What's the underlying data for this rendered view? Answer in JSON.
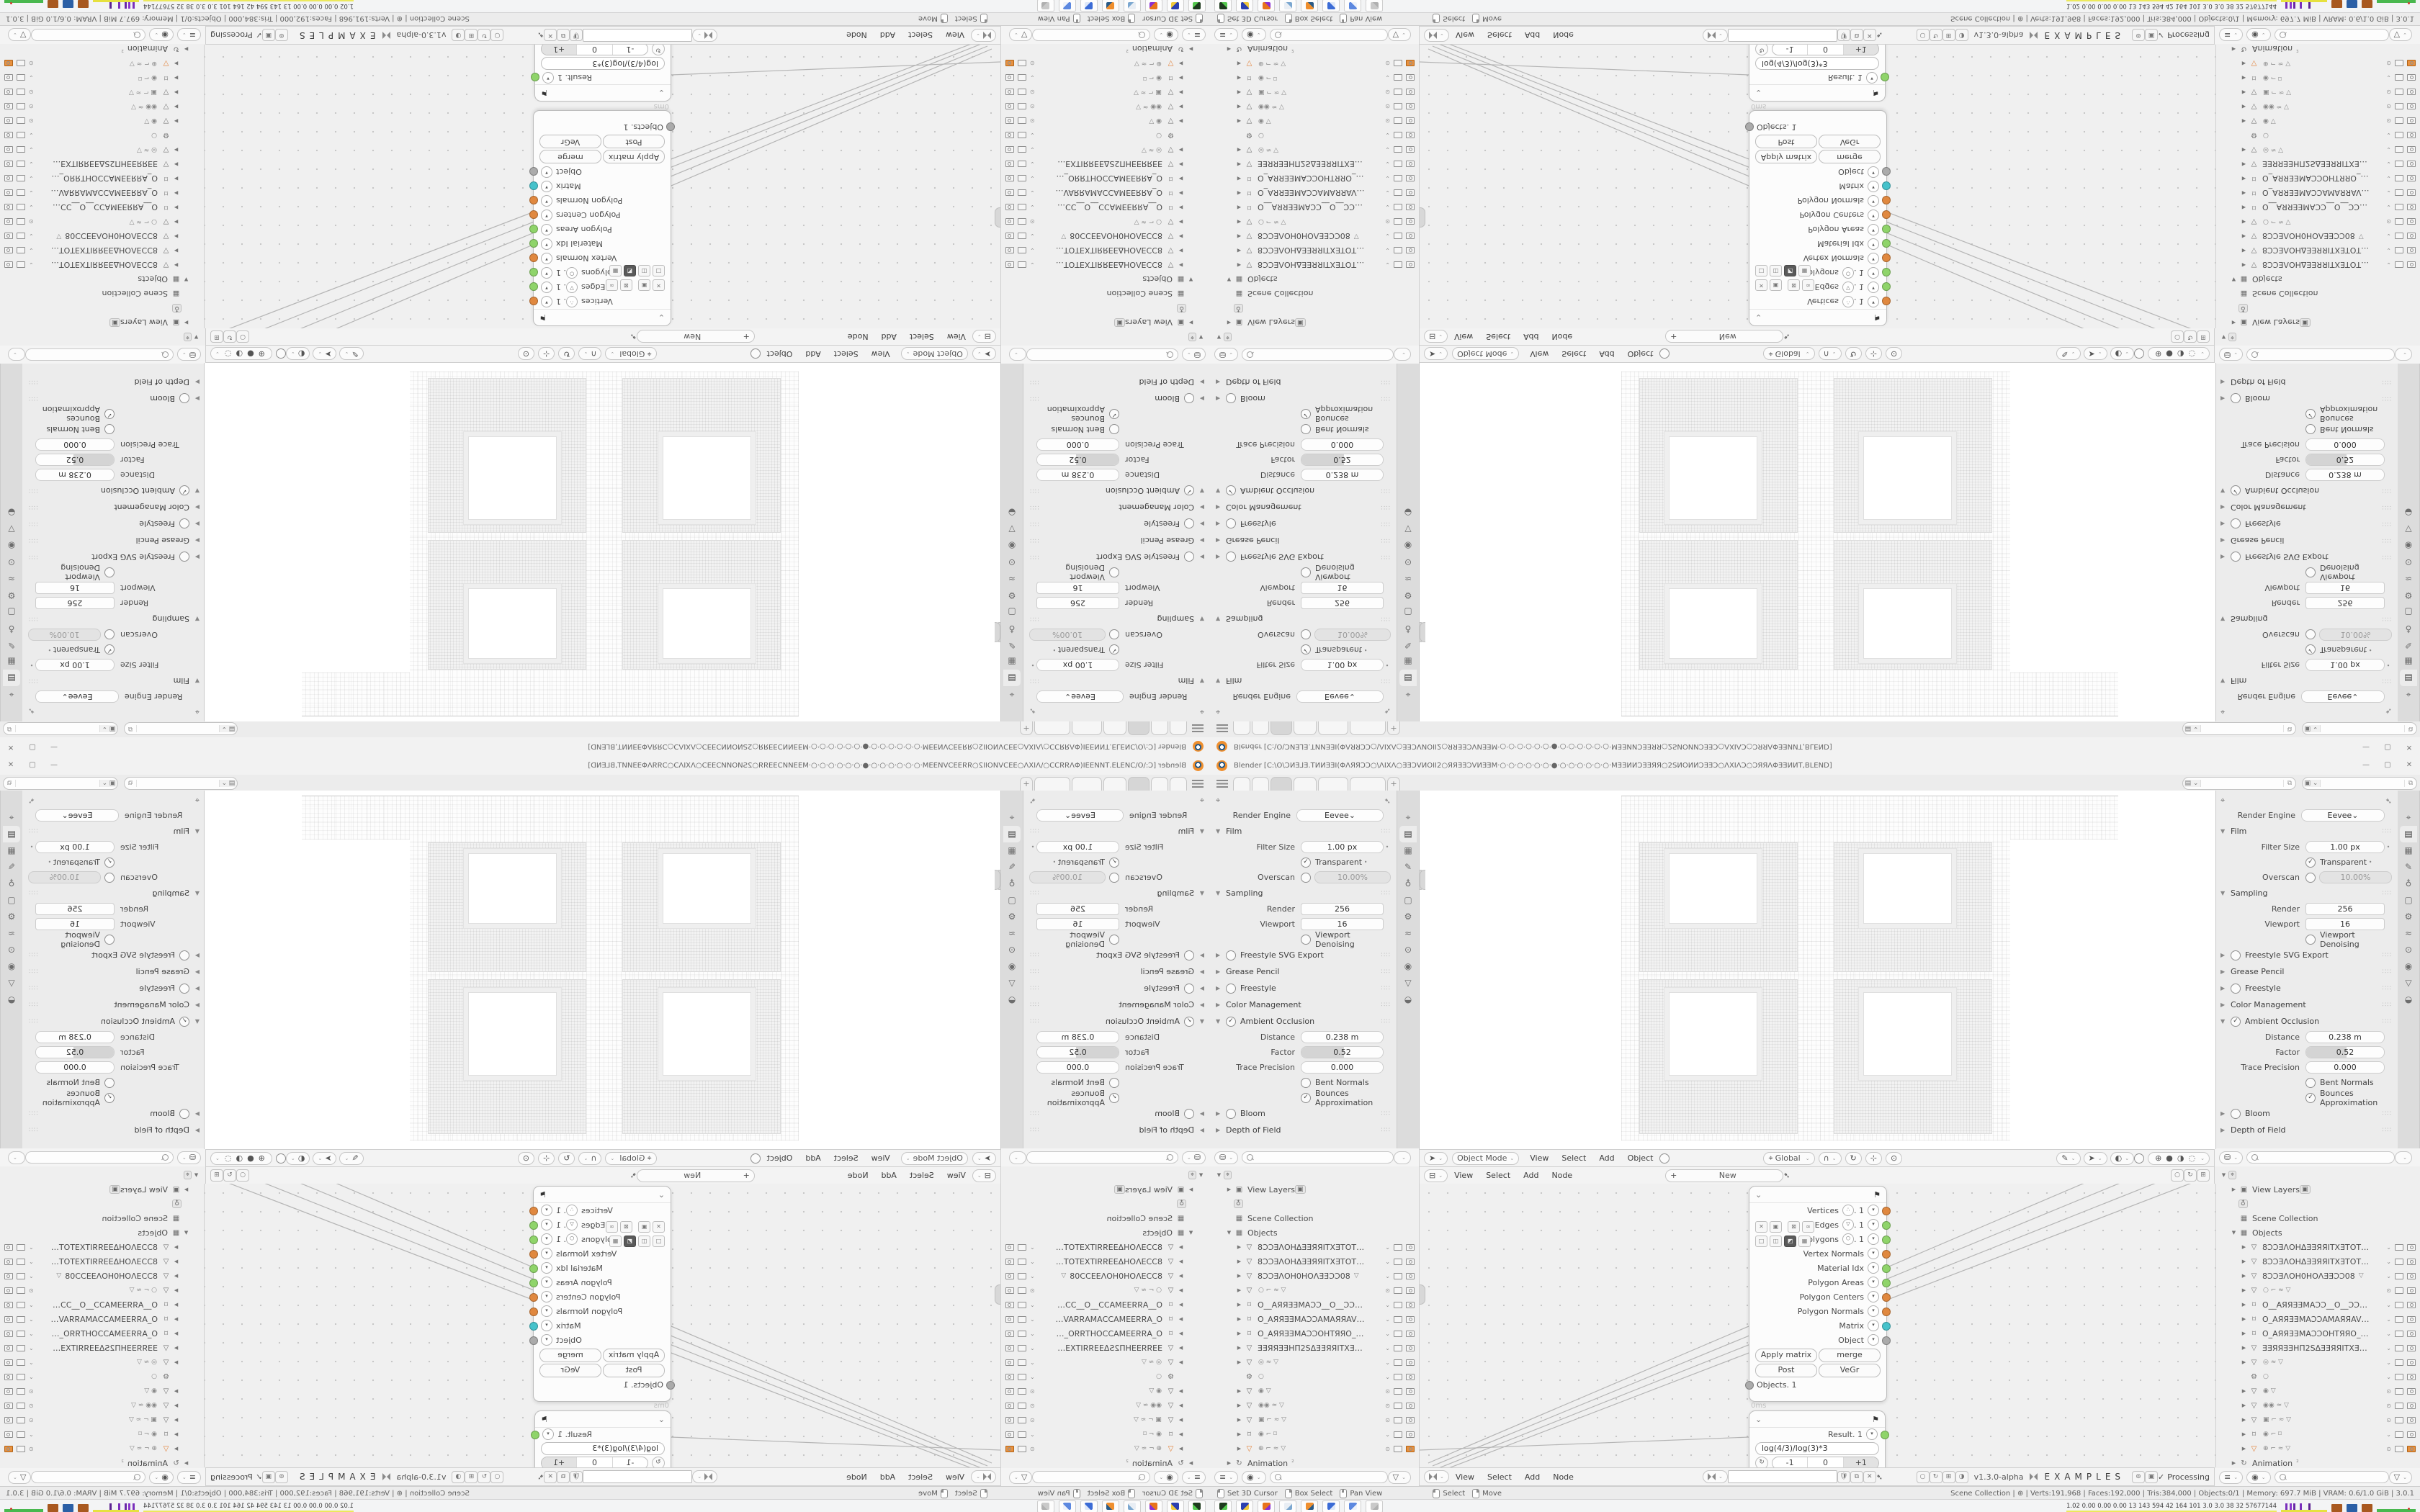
{
  "window": {
    "title": "Blender [C:\\O\\ƆͶƎ⅃Ǝ.TͶИƎƎI(ΦΛЯЯƆƆ○\\ΛIXΛ○ƎƎƆVͶOII2○ЯЯƎƎƆVͶƎƎM·○·○·○·○·○·○·●·○·○·○·○·○·○·MƎƎͶͶƆƎƎЯЯ○2SͶOͶͶƆƎƎƆ○ΛXIΛƆ○ƆЯЯΛΦƎƎͶͶT,BLEND]",
    "controls": {
      "minimize": "—",
      "maximize": "▢",
      "close": "✕"
    }
  },
  "topbar": {
    "tabs": [
      "",
      "",
      "",
      "",
      "",
      ""
    ],
    "active_tab_index": 2,
    "add_tab_label": "+",
    "scene_selector": {
      "icon": "scene-icon",
      "value": "",
      "copy": "⧉"
    },
    "view_layer_selector": {
      "icon": "view-layer-icon",
      "value": "",
      "copy": "⧉"
    }
  },
  "properties": {
    "render_engine_label": "Render Engine",
    "render_engine_value": "Eevee",
    "tab_icons": [
      "⌖",
      "▤",
      "▦",
      "✎",
      "♁",
      "▢",
      "⚙",
      "≈",
      "⊙",
      "◉",
      "▽",
      "◒"
    ],
    "active_tab_index": 1,
    "sections": [
      {
        "title": "Film",
        "open": true,
        "rows": [
          {
            "type": "value",
            "label": "Filter Size",
            "value": "1.00 px",
            "dot": true
          },
          {
            "type": "check",
            "label": "Transparent",
            "checked": true,
            "dot": true
          },
          {
            "type": "toggle_value",
            "label": "Overscan",
            "checked": false,
            "value": "10.00%",
            "disabled": true
          }
        ]
      },
      {
        "title": "Sampling",
        "open": true,
        "rows": [
          {
            "type": "value_sq",
            "label": "Render",
            "value": "256"
          },
          {
            "type": "value_sq",
            "label": "Viewport",
            "value": "16"
          },
          {
            "type": "check",
            "label": "Viewport Denoising",
            "checked": false
          }
        ]
      },
      {
        "title": "Freestyle SVG Export",
        "open": false,
        "check": false
      },
      {
        "title": "Grease Pencil",
        "open": false
      },
      {
        "title": "Freestyle",
        "open": false,
        "check": false
      },
      {
        "title": "Color Management",
        "open": false
      },
      {
        "title": "Ambient Occlusion",
        "open": true,
        "check": true,
        "rows": [
          {
            "type": "value",
            "label": "Distance",
            "value": "0.238 m"
          },
          {
            "type": "slider",
            "label": "Factor",
            "value": "0.52",
            "fraction": 0.52
          },
          {
            "type": "value",
            "label": "Trace Precision",
            "value": "0.000"
          },
          {
            "type": "check",
            "label": "Bent Normals",
            "checked": false
          },
          {
            "type": "check",
            "label": "Bounces Approximation",
            "checked": true
          }
        ]
      },
      {
        "title": "Bloom",
        "open": false,
        "check": false
      },
      {
        "title": "Depth of Field",
        "open": false
      }
    ]
  },
  "outliner": {
    "top_rows": [
      {
        "kind": "tool",
        "icon": "⌖"
      },
      {
        "kind": "item",
        "arrow": "closed",
        "icon": "▣",
        "label": "View Layers",
        "badge": "▣"
      },
      {
        "kind": "icon_only",
        "icon": "♁"
      },
      {
        "kind": "item",
        "icon": "▦",
        "label": "Scene Collection"
      },
      {
        "kind": "item",
        "arrow": "open",
        "icon": "▦",
        "label": "Objects"
      }
    ],
    "objects": [
      {
        "icon": "mesh",
        "name": "8ƆƆƎΛOHΔƎƎЯЯITXƎTOTƎƎXTI8",
        "vis": "chk"
      },
      {
        "icon": "mesh",
        "name": "8ƆƆƎΛOHΔƎƎЯЯITXƎTOTƎƎXTI8",
        "vis": "chk"
      },
      {
        "icon": "mesh",
        "name": "8ƆƆƎΛOH0HOΛƎƎƆƆ08",
        "glyphs": "▽",
        "vis": "chk"
      },
      {
        "icon": "mesh",
        "name": "",
        "glyphs": "○  ⌐ ≈ ▽",
        "vis": "eye"
      },
      {
        "icon": "camera",
        "name": "O__AЯЯƎƎMAƆƆ__O__ƆƆAMƎI",
        "vis": "chk"
      },
      {
        "icon": "camera",
        "name": "O_AЯЯƎƎMAƆƆAMAЯЯAVИAΠ_O",
        "vis": "chk"
      },
      {
        "icon": "camera",
        "name": "O_AЯЯƎƎMAƆƆOHTЯЯO_O_OЯTH",
        "vis": "chk"
      },
      {
        "icon": "mesh",
        "name": "ƎƎЯЯƎƎHΠ2SΔƎƎЯЯITXƎTOTƎƎXTL",
        "vis": "chk"
      },
      {
        "icon": "mesh",
        "name": "",
        "glyphs": "◎  ≈ ▽",
        "vis": "chk"
      },
      {
        "icon": "wrench",
        "name": "",
        "glyphs": "○",
        "vis": "chk",
        "noarrow": true
      },
      {
        "icon": "mesh",
        "name": "",
        "glyphs": "◉  ▽",
        "vis": "eye"
      },
      {
        "icon": "mesh",
        "name": "",
        "glyphs": "◉◉  ≈ ▽",
        "vis": "eye"
      },
      {
        "icon": "mesh",
        "name": "",
        "glyphs": "▣  ⌐ ≈ ▽",
        "vis": "eye"
      },
      {
        "icon": "camera",
        "name": "",
        "glyphs": "◉  ⌐ ⌑",
        "vis": "chk"
      },
      {
        "icon": "mesh",
        "name": "",
        "glyphs": "⊕  ⌐ ≈ ▽",
        "vis": "eye",
        "active": true,
        "render_on": true
      }
    ],
    "bottom_row": {
      "kind": "item",
      "arrow": "closed",
      "icon": "↻",
      "label": "Animation",
      "suffix": "²"
    },
    "footer_icons": [
      "≡",
      "◉"
    ],
    "footer_filter": "▽"
  },
  "viewport_header": {
    "tool_icon": "➤",
    "mode": "Object Mode",
    "menus": [
      "View",
      "Select",
      "Add",
      "Object"
    ],
    "orientation_icon": "⌖",
    "orientation": "Global",
    "snap_icon": "∩",
    "extra_icons": [
      "↻",
      "⊹",
      "⊙"
    ],
    "shade_icons": [
      "✎",
      "➤",
      "◐"
    ],
    "shading_modes": [
      "⊕",
      "●",
      "◑",
      "◌"
    ]
  },
  "node_editor": {
    "header": {
      "editor_icon": "⊟",
      "menus": [
        "View",
        "Select",
        "Add",
        "Node"
      ],
      "plus": "+",
      "new_label": "New",
      "right_icons": [
        "○",
        "↻",
        "⊞"
      ]
    },
    "group_node": {
      "outputs": [
        {
          "label": "Vertices",
          "icon": "∴",
          "suffix": ". 1",
          "color": "#e0883f"
        },
        {
          "label": "Edges",
          "icon": "▽",
          "suffix": ". 1",
          "color": "#8fd46a"
        },
        {
          "label": "Polygons",
          "icon": "⬡",
          "suffix": ". 1",
          "color": "#8fd46a"
        },
        {
          "label": "Vertex Normals",
          "color": "#e0883f"
        },
        {
          "label": "Material Idx",
          "color": "#8fd46a"
        },
        {
          "label": "Polygon Areas",
          "color": "#8fd46a"
        },
        {
          "label": "Polygon Centers",
          "color": "#e0883f"
        },
        {
          "label": "Polygon Normals",
          "color": "#e0883f"
        },
        {
          "label": "Matrix",
          "color": "#46c2cb"
        },
        {
          "label": "Object",
          "color": "#ababab"
        }
      ],
      "toggle_row1": [
        "✕",
        "▣",
        "⊠",
        "∞"
      ],
      "toggle_row2": [
        "□",
        "◫",
        "◩",
        "▦"
      ],
      "dark_toggle_index": 2,
      "buttons": [
        [
          "Apply matrix",
          "merge"
        ],
        [
          "Post",
          "VeGr"
        ]
      ],
      "input_socket": {
        "label": "Objects. 1",
        "color": "#ababab"
      },
      "time": "0ms",
      "header_icon": "⚑"
    },
    "result_node": {
      "output_label": "Result. 1",
      "output_color": "#8fd46a",
      "formula": "log(4/3)/log(3)*3",
      "stepper": [
        "-1",
        "0",
        "+1"
      ],
      "active_step_index": 2,
      "refresh_icon": "↻"
    },
    "footer": {
      "editor_icon_svk": "sverchok-icon",
      "menus": [
        "View",
        "Select",
        "Add",
        "Node"
      ],
      "tree_value": "",
      "tree_buttons": [
        "🛡",
        "⧉",
        "✕"
      ],
      "right_icons": [
        "○",
        "↻",
        "⊞",
        "◑"
      ],
      "version": "v1.3.0-alpha",
      "title": "EXAMPLES",
      "gizmo_buttons": [
        "⊚",
        "▣"
      ],
      "status_check": "✓",
      "status": "Processing"
    }
  },
  "status_bar": {
    "hints": [
      "Set 3D Cursor",
      "Box Select",
      "Pan View"
    ],
    "hints2": [
      "Select",
      "Move"
    ],
    "stats": "Scene Collection  |  ⊕  |  Verts:191,968  |  Faces:192,000  |  Tris:384,000  |  Objects:0/1  |  Memory: 697.7 MiB  |  VRAM: 0.6/1.0 GiB  |  3.0.1"
  },
  "taskbar": {
    "apps": [
      {
        "name": "recorder-app-icon",
        "color": "#1d3a1d",
        "accent": "#54c94e"
      },
      {
        "name": "floppy64-app-icon",
        "color": "#2b3fb0",
        "accent": "#f0c83c"
      },
      {
        "name": "firefox-app-icon",
        "color": "#e8731a",
        "accent": "#8a2fd0"
      },
      {
        "name": "notepad-app-icon",
        "color": "#e9eef4",
        "accent": "#7ba7d0"
      },
      {
        "name": "blender-app-icon",
        "color": "#ef8f2e",
        "accent": "#2a5a86"
      },
      {
        "name": "calculator-app-icon",
        "color": "#3c6cd6",
        "accent": "#dfe8f8"
      },
      {
        "name": "calculator2-app-icon",
        "color": "#5c88e0",
        "accent": "#eef2fa"
      },
      {
        "name": "inactive-app-icon",
        "color": "#c9c9c9",
        "accent": "#b0b0b0"
      }
    ],
    "perf_stats": "1.02 0.00 0.00 0.00   13   143   594   42   164   101   3.0   3.0   38   32   57677144",
    "blocks": [
      "#a8581f",
      "#2b5fa5",
      "#a8581f"
    ]
  },
  "quadrants": [
    {
      "name": "tile-top-left",
      "transform": "rotate-180"
    },
    {
      "name": "tile-top-right",
      "transform": "flip-vertical"
    },
    {
      "name": "tile-bottom-left",
      "transform": "flip-horizontal"
    },
    {
      "name": "tile-bottom-right",
      "transform": "none"
    }
  ]
}
